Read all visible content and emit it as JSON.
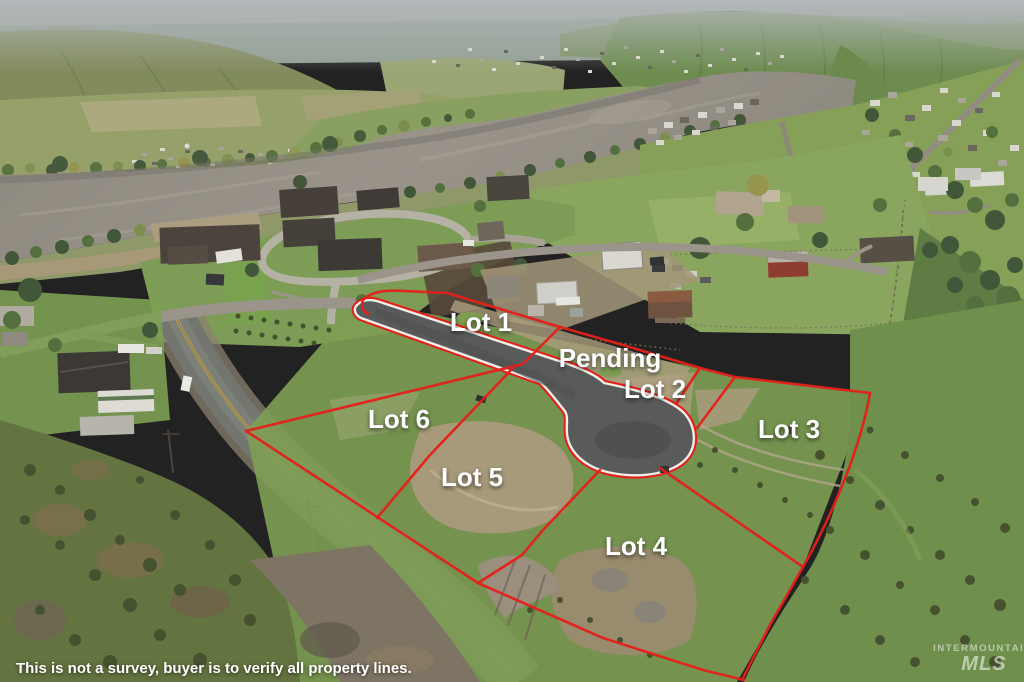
{
  "scene": {
    "description": "Aerial drone photo of a riverside community with a new cul-de-sac land subdivision outlined in red"
  },
  "overlay": {
    "lots": [
      {
        "id": "lot-1",
        "label": "Lot 1"
      },
      {
        "id": "pending",
        "label": "Pending"
      },
      {
        "id": "lot-2",
        "label": "Lot 2"
      },
      {
        "id": "lot-3",
        "label": "Lot 3"
      },
      {
        "id": "lot-4",
        "label": "Lot 4"
      },
      {
        "id": "lot-5",
        "label": "Lot 5"
      },
      {
        "id": "lot-6",
        "label": "Lot 6"
      }
    ],
    "boundary_color": "#e3201a",
    "label_color": "#ffffff",
    "disclaimer": "This is not a survey, buyer is to verify all property lines.",
    "watermark": {
      "line1": "INTERMOUNTAIN",
      "line2": "MLS"
    }
  }
}
